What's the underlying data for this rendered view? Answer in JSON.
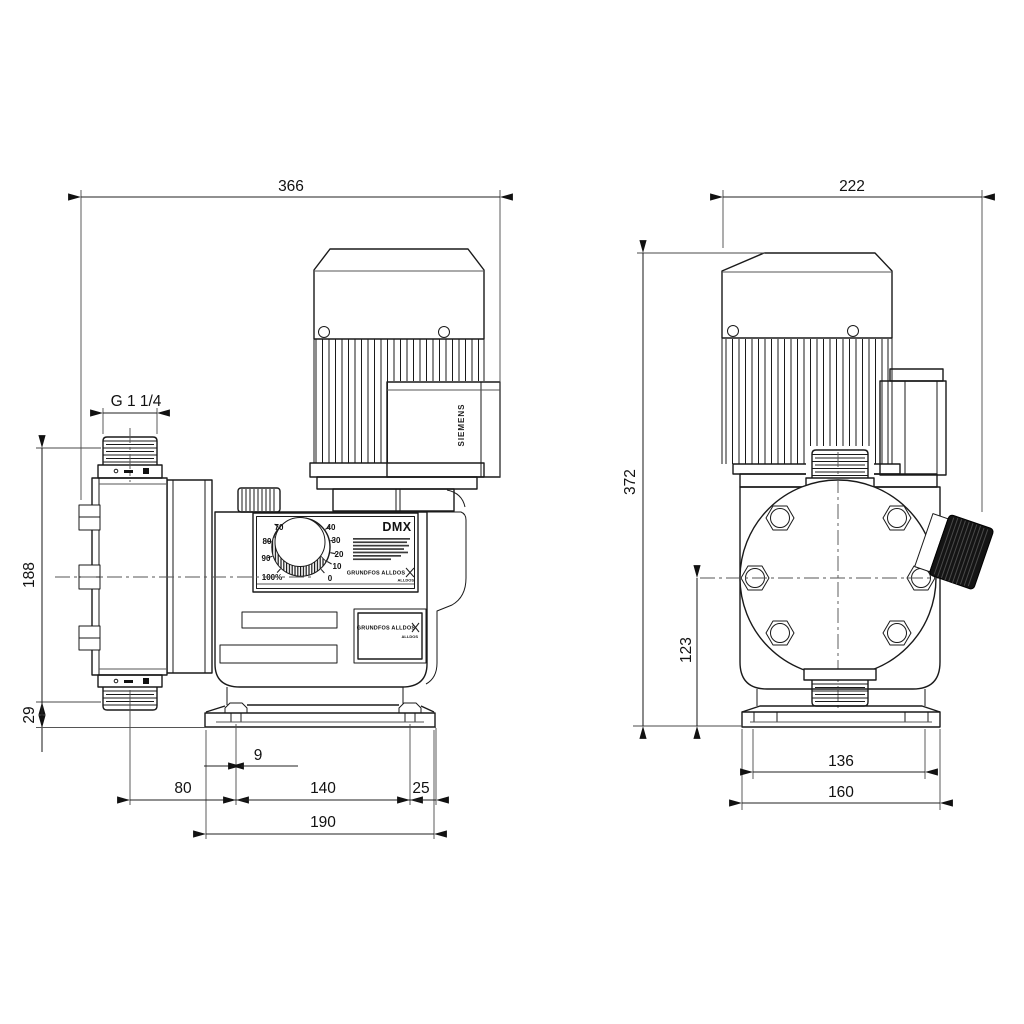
{
  "drawing": {
    "background": "#ffffff",
    "line_color": "#1a1a1a",
    "knob_color": "#141414"
  },
  "dimensions": {
    "side_overall_width": "366",
    "side_thread": "G 1 1/4",
    "side_head_height": "188",
    "side_below_base": "29",
    "side_slot_width": "9",
    "side_head_to_bolt": "80",
    "side_bolt_spacing": "140",
    "side_bolt_to_edge": "25",
    "side_base_length": "190",
    "front_overall_width": "222",
    "front_overall_height": "372",
    "front_center_height": "123",
    "front_slot_spacing": "136",
    "front_base_width": "160"
  },
  "labels": {
    "model": "DMX",
    "motor_brand": "SIEMENS",
    "brand": "GRUNDFOS ALLDOS",
    "brand_sub": "ALLDOS"
  },
  "dial": {
    "ticks": [
      "100%",
      "90",
      "80",
      "70",
      "40",
      "30",
      "20",
      "10",
      "0"
    ]
  }
}
